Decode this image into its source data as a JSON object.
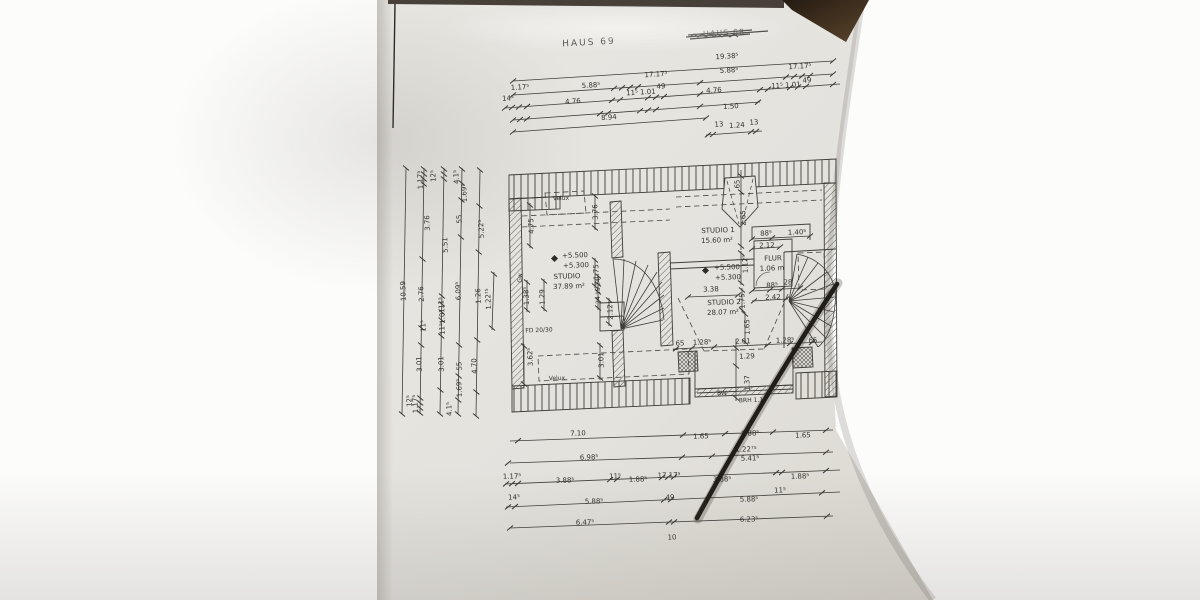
{
  "scene": {
    "description": "Photo of an architectural floor plan sheet (attic storey) lying on a wooden table",
    "paper_color": "#e6e4df",
    "line_color": "#3f3d38",
    "cable_color": "#211d18",
    "wood_color": "#4a3526",
    "background_color": "#fbfbfa"
  },
  "titles": {
    "haus": "HAUS 69",
    "haus_crossed": "HAUS 68"
  },
  "label_groups": {
    "top_dims": [
      {
        "t": "19.38⁵",
        "x": 727,
        "y": 57
      },
      {
        "t": "5.88⁵",
        "x": 591,
        "y": 86
      },
      {
        "t": "17.17⁵",
        "x": 656,
        "y": 75
      },
      {
        "t": "5.88⁵",
        "x": 729,
        "y": 71
      },
      {
        "t": "17.17⁵",
        "x": 800,
        "y": 67
      },
      {
        "t": "1.17⁵",
        "x": 520,
        "y": 88
      },
      {
        "t": "14⁵",
        "x": 508,
        "y": 99
      },
      {
        "t": "11⁵ 1.01",
        "x": 641,
        "y": 93
      },
      {
        "t": "49",
        "x": 661,
        "y": 87
      },
      {
        "t": "4.76",
        "x": 714,
        "y": 91
      },
      {
        "t": "11⁵ 1.01",
        "x": 786,
        "y": 86
      },
      {
        "t": "49",
        "x": 807,
        "y": 81
      },
      {
        "t": "4.76",
        "x": 573,
        "y": 102
      },
      {
        "t": "1.50",
        "x": 731,
        "y": 107
      },
      {
        "t": "8.94",
        "x": 609,
        "y": 118
      },
      {
        "t": "13",
        "x": 719,
        "y": 125
      },
      {
        "t": "1.24",
        "x": 737,
        "y": 126
      },
      {
        "t": "13",
        "x": 754,
        "y": 123
      }
    ],
    "bottom_dims": [
      {
        "t": "7.10",
        "x": 578,
        "y": 434
      },
      {
        "t": "1.65",
        "x": 701,
        "y": 437
      },
      {
        "t": "1.88⁵",
        "x": 750,
        "y": 434
      },
      {
        "t": "1.65",
        "x": 803,
        "y": 436
      },
      {
        "t": "6.98⁵",
        "x": 589,
        "y": 458
      },
      {
        "t": "1.22⁷⁵",
        "x": 746,
        "y": 450
      },
      {
        "t": "5.41⁵",
        "x": 750,
        "y": 459
      },
      {
        "t": "1.17⁵",
        "x": 512,
        "y": 477
      },
      {
        "t": "3.88⁵",
        "x": 565,
        "y": 481
      },
      {
        "t": "11⁵",
        "x": 615,
        "y": 477
      },
      {
        "t": "1.88⁵",
        "x": 638,
        "y": 480
      },
      {
        "t": "17.17⁵",
        "x": 669,
        "y": 476
      },
      {
        "t": "3.88⁵",
        "x": 722,
        "y": 480
      },
      {
        "t": "1.88⁵",
        "x": 800,
        "y": 477
      },
      {
        "t": "11⁵",
        "x": 780,
        "y": 491
      },
      {
        "t": "14⁵",
        "x": 514,
        "y": 498
      },
      {
        "t": "5.88⁵",
        "x": 594,
        "y": 502
      },
      {
        "t": "49",
        "x": 670,
        "y": 498
      },
      {
        "t": "5.88⁵",
        "x": 749,
        "y": 500
      },
      {
        "t": "6.47⁵",
        "x": 585,
        "y": 523
      },
      {
        "t": "6.23⁵",
        "x": 749,
        "y": 520
      },
      {
        "t": "10",
        "x": 672,
        "y": 538
      }
    ],
    "left_dims": [
      {
        "t": "10.59",
        "x": 404,
        "y": 291
      },
      {
        "t": "1.17⁵",
        "x": 421,
        "y": 180
      },
      {
        "t": "12⁵",
        "x": 434,
        "y": 176
      },
      {
        "t": "4.1⁵",
        "x": 457,
        "y": 177
      },
      {
        "t": "1.69⁵",
        "x": 465,
        "y": 193
      },
      {
        "t": "3.76",
        "x": 428,
        "y": 223
      },
      {
        "t": "55",
        "x": 460,
        "y": 219
      },
      {
        "t": "5.22⁵",
        "x": 482,
        "y": 229
      },
      {
        "t": "5.51",
        "x": 446,
        "y": 245
      },
      {
        "t": "2.76",
        "x": 422,
        "y": 294
      },
      {
        "t": "11⁵",
        "x": 424,
        "y": 326
      },
      {
        "t": "6.09⁵",
        "x": 459,
        "y": 291
      },
      {
        "t": "1.26",
        "x": 479,
        "y": 296
      },
      {
        "t": "1.22⁷⁵",
        "x": 489,
        "y": 299
      },
      {
        "t": "11⁵",
        "x": 442,
        "y": 303
      },
      {
        "t": "1.01",
        "x": 443,
        "y": 316
      },
      {
        "t": "11⁵",
        "x": 443,
        "y": 329
      },
      {
        "t": "3.01",
        "x": 420,
        "y": 364
      },
      {
        "t": "3.01",
        "x": 442,
        "y": 364
      },
      {
        "t": "55",
        "x": 460,
        "y": 366
      },
      {
        "t": "4.70",
        "x": 475,
        "y": 366
      },
      {
        "t": "1.69⁵",
        "x": 460,
        "y": 388
      },
      {
        "t": "4.1⁵",
        "x": 450,
        "y": 409
      },
      {
        "t": "12⁵",
        "x": 410,
        "y": 401
      },
      {
        "t": "1.17⁵",
        "x": 416,
        "y": 404
      }
    ],
    "plan_texts": [
      {
        "t": "Velux",
        "x": 561,
        "y": 199,
        "fs": 6
      },
      {
        "t": "Velux",
        "x": 557,
        "y": 379,
        "fs": 6
      },
      {
        "t": "STUDIO",
        "x": 567,
        "y": 277
      },
      {
        "t": "37.89 m²",
        "x": 569,
        "y": 287
      },
      {
        "t": "STUDIO 1",
        "x": 718,
        "y": 231
      },
      {
        "t": "15.60 m²",
        "x": 717,
        "y": 241
      },
      {
        "t": "STUDIO 2",
        "x": 724,
        "y": 303
      },
      {
        "t": "28.07 m²",
        "x": 723,
        "y": 313
      },
      {
        "t": "FLUR",
        "x": 773,
        "y": 259
      },
      {
        "t": "1.06 m",
        "x": 772,
        "y": 269
      },
      {
        "t": "+5.500",
        "x": 575,
        "y": 256
      },
      {
        "t": "+5.300",
        "x": 576,
        "y": 266
      },
      {
        "t": "+5.500",
        "x": 727,
        "y": 268
      },
      {
        "t": "+5.300",
        "x": 728,
        "y": 278
      },
      {
        "t": "FD 20/30",
        "x": 539,
        "y": 331,
        "fs": 6
      },
      {
        "t": "BW",
        "x": 722,
        "y": 394,
        "fs": 6
      },
      {
        "t": "BRH 1.1",
        "x": 751,
        "y": 401,
        "fs": 6
      },
      {
        "t": "Gw",
        "x": 521,
        "y": 278,
        "fs": 6,
        "r": -90
      }
    ],
    "plan_dims": [
      {
        "t": "4.75",
        "x": 532,
        "y": 226,
        "r": -92
      },
      {
        "t": "3.76",
        "x": 596,
        "y": 212,
        "r": -92
      },
      {
        "t": "1.75",
        "x": 597,
        "y": 272,
        "r": -92
      },
      {
        "t": "1.38⁵",
        "x": 527,
        "y": 296,
        "r": -92
      },
      {
        "t": "1.29",
        "x": 543,
        "y": 297,
        "r": -92
      },
      {
        "t": "3.62⁵",
        "x": 531,
        "y": 357,
        "r": -92
      },
      {
        "t": "3.01",
        "x": 602,
        "y": 360,
        "r": -92
      },
      {
        "t": "3.38",
        "x": 711,
        "y": 290
      },
      {
        "t": "65",
        "x": 738,
        "y": 184,
        "r": -92
      },
      {
        "t": "2.65",
        "x": 744,
        "y": 218,
        "r": -92
      },
      {
        "t": "1.12⁵",
        "x": 746,
        "y": 264,
        "r": -92
      },
      {
        "t": "88⁵",
        "x": 766,
        "y": 234
      },
      {
        "t": "1.40⁵",
        "x": 797,
        "y": 233
      },
      {
        "t": "2.12",
        "x": 767,
        "y": 246
      },
      {
        "t": "88⁵",
        "x": 772,
        "y": 286
      },
      {
        "t": "28",
        "x": 788,
        "y": 283
      },
      {
        "t": "2.42",
        "x": 773,
        "y": 298
      },
      {
        "t": "1.75",
        "x": 743,
        "y": 301,
        "r": -92
      },
      {
        "t": "1.65",
        "x": 748,
        "y": 327,
        "r": -92
      },
      {
        "t": "65",
        "x": 680,
        "y": 344
      },
      {
        "t": "1.28⁵",
        "x": 702,
        "y": 343
      },
      {
        "t": "2.01",
        "x": 743,
        "y": 342
      },
      {
        "t": "1.28⁵",
        "x": 785,
        "y": 341
      },
      {
        "t": "65",
        "x": 813,
        "y": 341
      },
      {
        "t": "1.29",
        "x": 747,
        "y": 357
      },
      {
        "t": "1.37",
        "x": 748,
        "y": 383,
        "r": -92
      },
      {
        "t": "24",
        "x": 599,
        "y": 282,
        "r": -92,
        "fs": 6
      },
      {
        "t": "15",
        "x": 599,
        "y": 291,
        "r": -92,
        "fs": 6
      },
      {
        "t": "24",
        "x": 599,
        "y": 300,
        "r": -92,
        "fs": 6
      },
      {
        "t": "2.12",
        "x": 611,
        "y": 312,
        "r": -92
      }
    ]
  }
}
